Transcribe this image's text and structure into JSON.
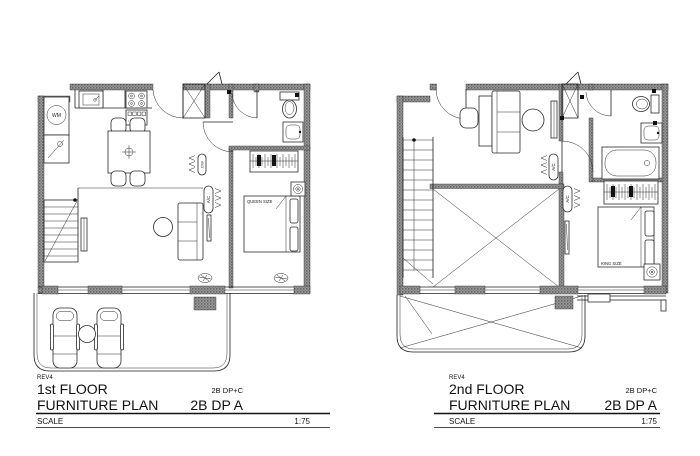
{
  "document": {
    "type": "architectural floor plan drawing",
    "ink_color": "#1f1f1f",
    "paper_color": "#ffffff"
  },
  "plans": {
    "first": {
      "labels": {
        "rev": "REV4",
        "floor": "1st FLOOR",
        "plan_type": "FURNITURE PLAN",
        "code_small": "2B DP+C",
        "code": "2B DP A",
        "scale_label": "SCALE",
        "scale_value": "1:75",
        "bed": "QUEEN SIZE",
        "wm": "WM",
        "dw": "DW",
        "ac": "A/C"
      }
    },
    "second": {
      "labels": {
        "rev": "REV4",
        "floor": "2nd FLOOR",
        "plan_type": "FURNITURE PLAN",
        "code_small": "2B DP+C",
        "code": "2B DP A",
        "scale_label": "SCALE",
        "scale_value": "1:75",
        "bed": "KING SIZE",
        "ac": "A/C"
      }
    }
  }
}
